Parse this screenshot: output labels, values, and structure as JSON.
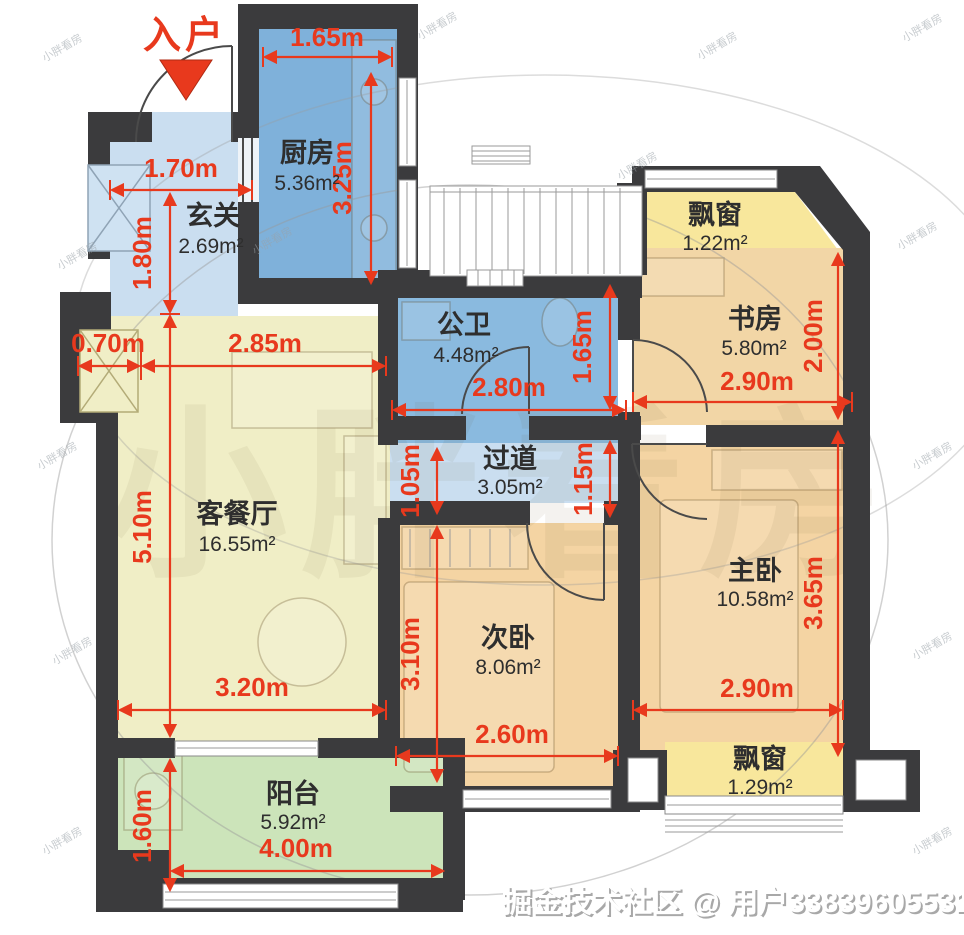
{
  "entrance": {
    "label": "入户"
  },
  "rooms": {
    "kitchen": {
      "name": "厨房",
      "area": "5.36m²",
      "width": "1.65m",
      "height": "3.25m"
    },
    "foyer": {
      "name": "玄关",
      "area": "2.69m²",
      "width": "1.70m",
      "height": "1.80m"
    },
    "bathroom": {
      "name": "公卫",
      "area": "4.48m²",
      "width": "2.80m",
      "height": "1.65m"
    },
    "hallway": {
      "name": "过道",
      "area": "3.05m²",
      "left": "1.05m",
      "right": "1.15m"
    },
    "study": {
      "name": "书房",
      "area": "5.80m²",
      "width": "2.90m",
      "height": "2.00m"
    },
    "study_bay": {
      "name": "飘窗",
      "area": "1.22m²"
    },
    "living": {
      "name": "客餐厅",
      "area": "16.55m²",
      "offset": "0.70m",
      "top": "2.85m",
      "height": "5.10m",
      "bottom": "3.20m"
    },
    "secondary": {
      "name": "次卧",
      "area": "8.06m²",
      "height": "3.10m",
      "width": "2.60m"
    },
    "master": {
      "name": "主卧",
      "area": "10.58m²",
      "height": "3.65m",
      "width": "2.90m"
    },
    "master_bay": {
      "name": "飘窗",
      "area": "1.29m²"
    },
    "balcony": {
      "name": "阳台",
      "area": "5.92m²",
      "height": "1.60m",
      "width": "4.00m"
    }
  },
  "colors": {
    "wall": "#3b3b3d",
    "kitchen": "#7fb1da",
    "bathroom": "#8abadf",
    "foyer": "#cadef0",
    "living": "#f0eec6",
    "bedroom": "#f4d4a3",
    "bay": "#f8e79c",
    "balcony": "#cce4ba",
    "dimension_red": "#e8391d"
  },
  "watermark": {
    "credit": "掘金技术社区 @ 用户33839605531",
    "stamp": "小胖看房"
  }
}
